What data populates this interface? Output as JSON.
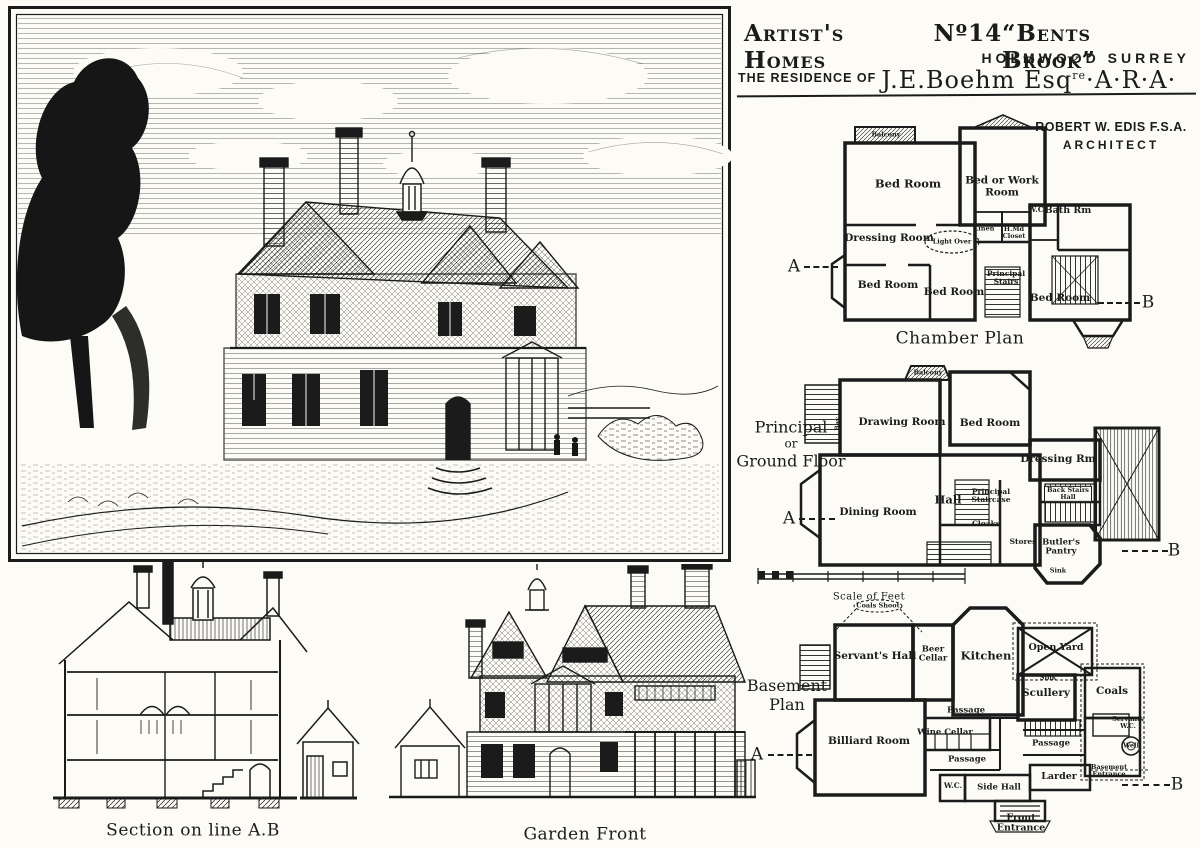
{
  "page": {
    "paper": "#fcfbf6",
    "ink": "#1b1b1b"
  },
  "title": {
    "series": "Artist's Homes",
    "number": "Nº14",
    "house_name": "“Bents Brook”",
    "location": "HOLMWOOD SURREY",
    "residence_prefix": "THE RESIDENCE OF",
    "resident": "J.E.Boehm Esq",
    "resident_sup": "re",
    "resident_suffix": "·A·R·A·"
  },
  "architect": {
    "name": "ROBERT W. EDIS F.S.A.",
    "role": "ARCHITECT"
  },
  "plans": {
    "chamber": {
      "caption": "Chamber Plan",
      "marker_a": "A",
      "marker_b": "B",
      "rooms": {
        "balcony": "Balcony",
        "bed1": "Bed Room",
        "bed_or_work": "Bed or Work Room",
        "wc": "W.C.",
        "bath": "Bath Rm",
        "dressing": "Dressing Room",
        "light_over": "Light Over",
        "linen": "Linen",
        "housemaids_closet": "H.Md Closet",
        "bed2": "Bed Room",
        "bed3": "Bed Room",
        "principal_stairs": "Principal Stairs",
        "bed4": "Bed Room"
      }
    },
    "ground": {
      "side1": "Principal",
      "side2": "or",
      "side3": "Ground Floor",
      "marker_a": "A",
      "marker_b": "B",
      "scale_caption": "Scale of Feet",
      "rooms": {
        "balcony": "Balcony",
        "bay": "Bay",
        "drawing": "Drawing Room",
        "bed": "Bed Room",
        "dressing": "Dressing Rm",
        "dining": "Dining Room",
        "hall": "Hall",
        "principal_staircase": "Principal Staircase",
        "cloaks": "Cloaks",
        "stores": "Stores",
        "butlers_pantry": "Butler's Pantry",
        "back_stairs_hall": "Back Stairs Hall",
        "sink": "Sink"
      }
    },
    "basement": {
      "side1": "Basement",
      "side2": "Plan",
      "marker_a": "A",
      "marker_b": "B",
      "rooms": {
        "coals_shoot": "Coals Shoot",
        "servants_hall": "Servant's Hall",
        "beer_cellar": "Beer Cellar",
        "kitchen": "Kitchen",
        "open_yard": "Open Yard",
        "scullery": "Scullery",
        "sink": "Sink",
        "coals": "Coals",
        "passage_upper": "Passage",
        "wine_cellar": "Wine Cellar",
        "billiard_room": "Billiard Room",
        "passage_lower": "Passage",
        "passage_right": "Passage",
        "larder": "Larder",
        "wc": "W.C.",
        "side_hall": "Side Hall",
        "front_entrance": "Front Entrance",
        "servants_wc": "Servants W.C.",
        "well": "Well",
        "basement_entrance": "Basement Entrance"
      }
    }
  },
  "elevations": {
    "section": {
      "caption": "Section on line A.B"
    },
    "garden": {
      "caption": "Garden Front"
    }
  }
}
